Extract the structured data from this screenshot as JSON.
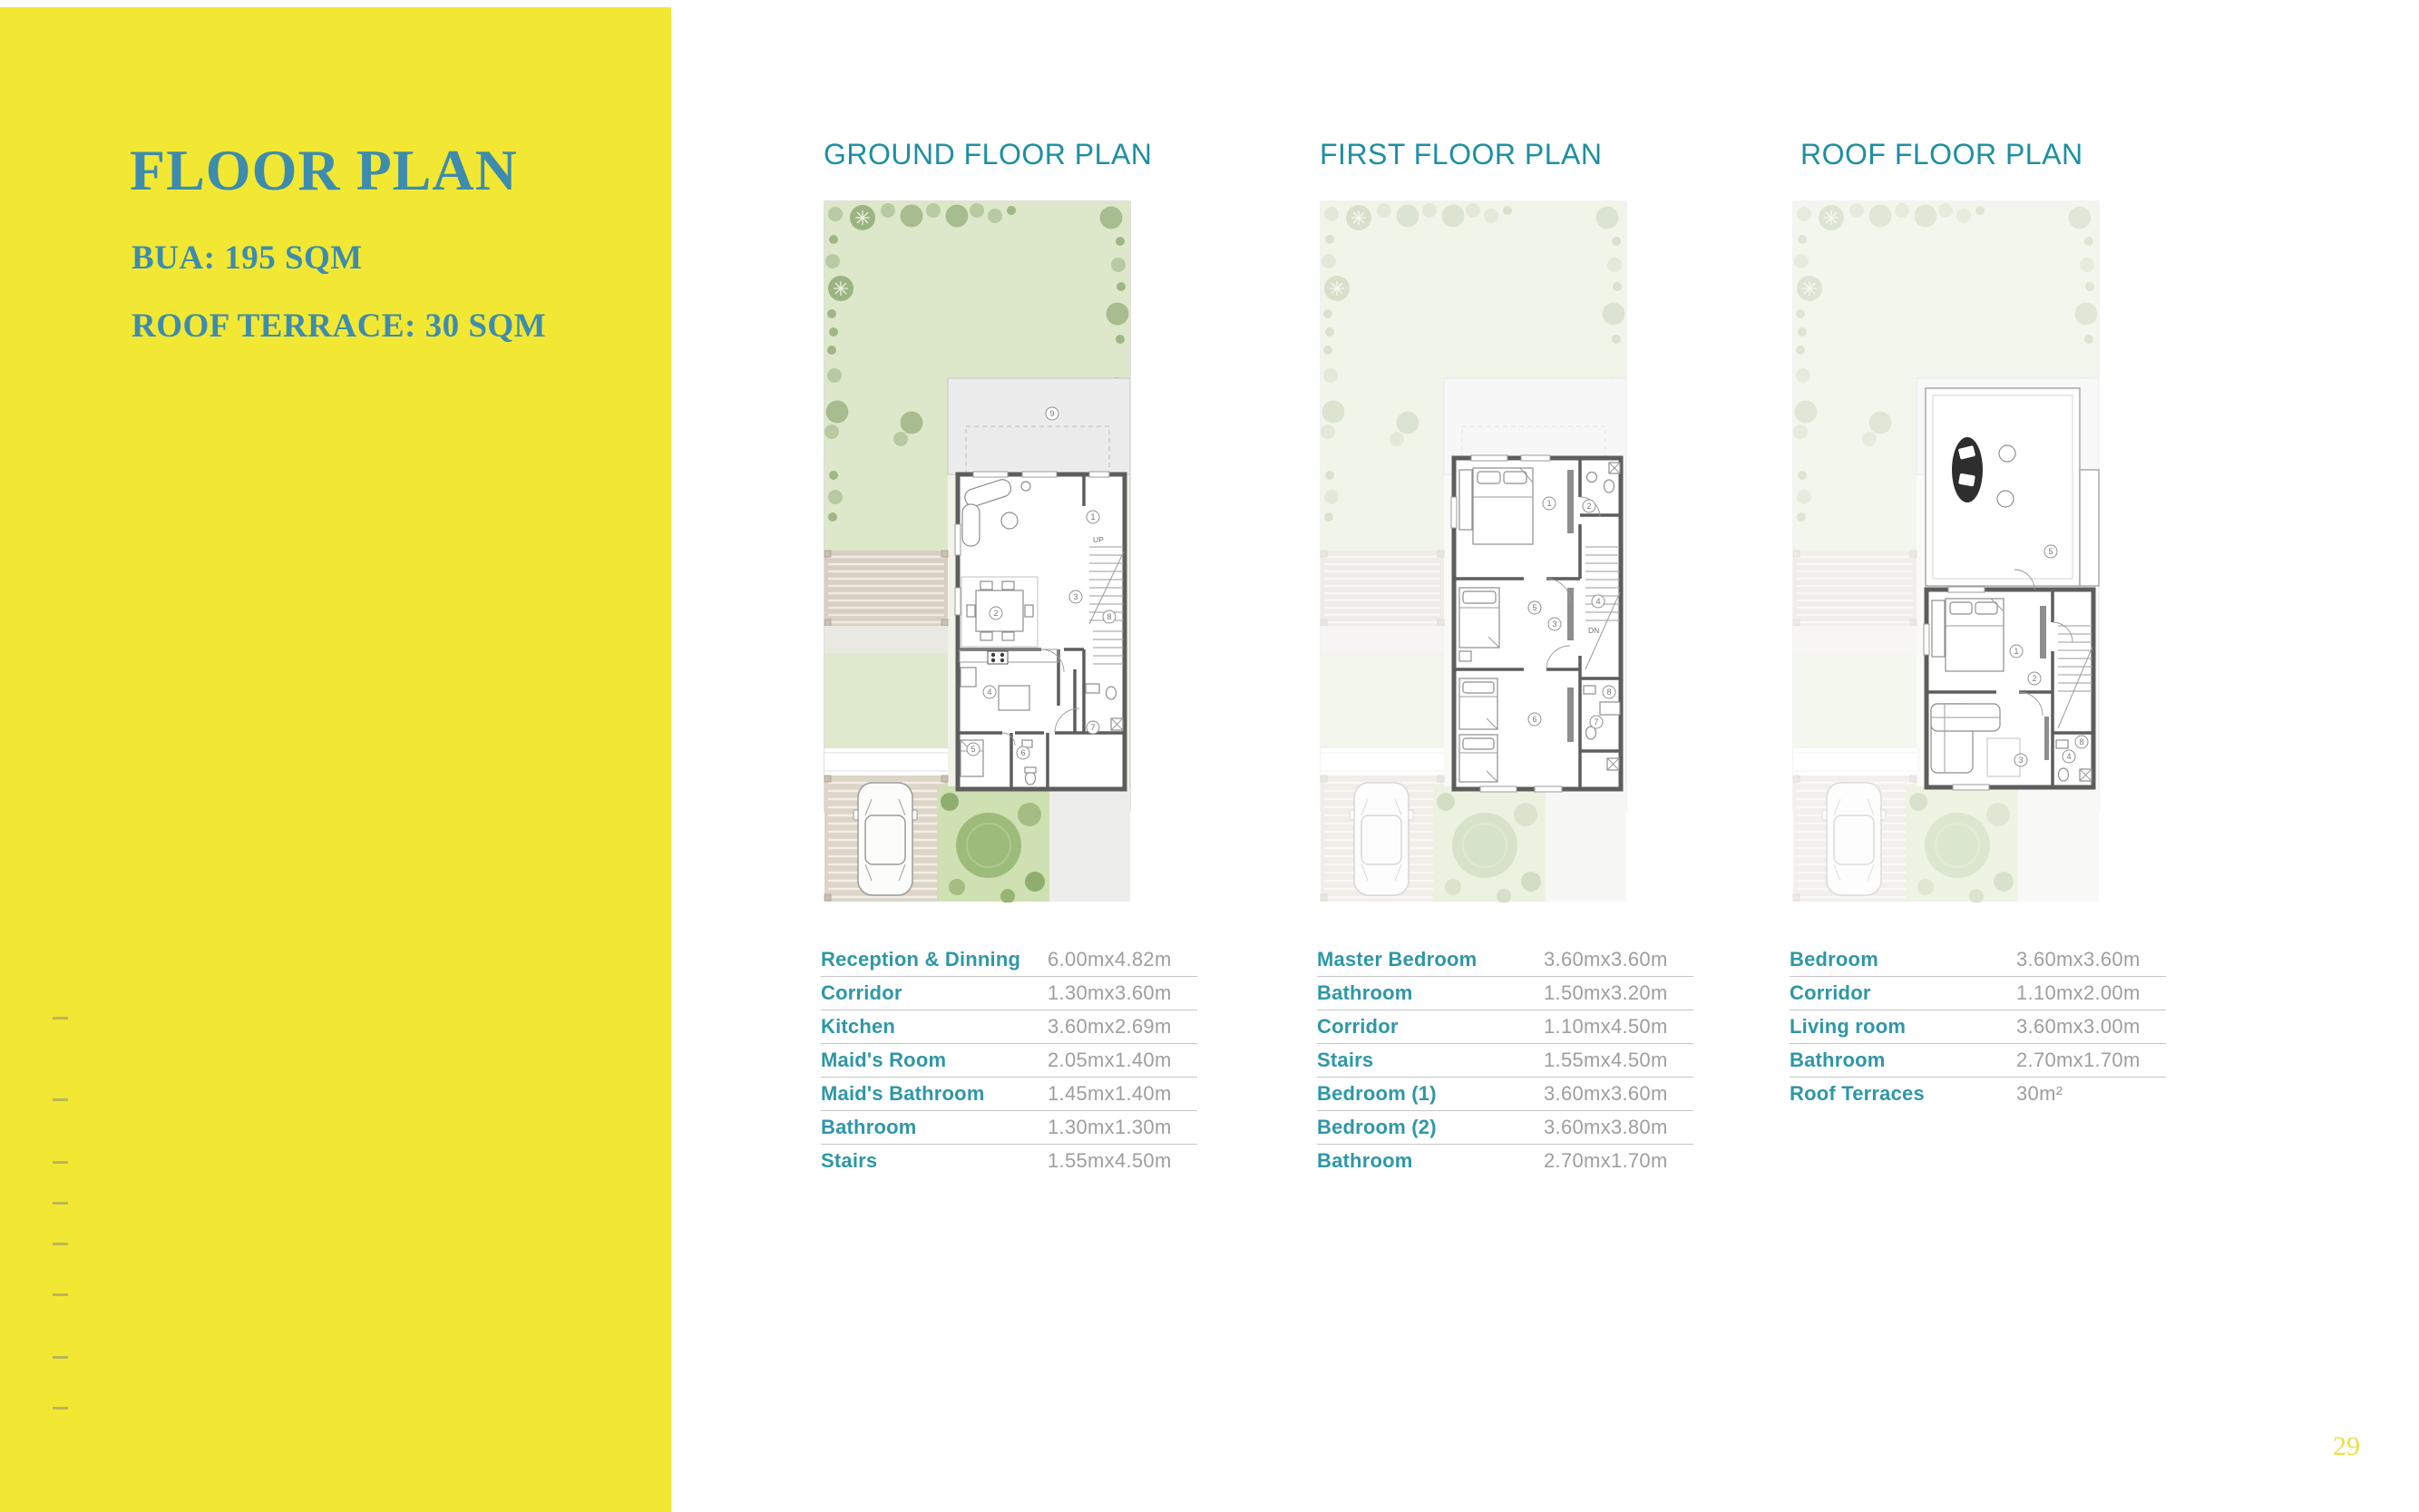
{
  "sidebar": {
    "title": "FLOOR PLAN",
    "bua": "BUA: 195 SQM",
    "roof_terrace": "ROOF TERRACE: 30 SQM",
    "background_color": "#F2E833",
    "text_color": "#3E8CAD"
  },
  "page_number": "29",
  "colors": {
    "heading_teal": "#1E8FA0",
    "table_label_teal": "#2F97A6",
    "dimension_gray": "#9E9E9E",
    "garden_green": "#DDE8CA",
    "page_number_yellow": "#E9DF45"
  },
  "plans": [
    {
      "title": "GROUND FLOOR PLAN",
      "image": "ground-floor-plan",
      "rooms": [
        {
          "label": "Reception & Dinning",
          "dim": "6.00mx4.82m"
        },
        {
          "label": "Corridor",
          "dim": "1.30mx3.60m"
        },
        {
          "label": "Kitchen",
          "dim": "3.60mx2.69m"
        },
        {
          "label": "Maid's Room",
          "dim": "2.05mx1.40m"
        },
        {
          "label": "Maid's Bathroom",
          "dim": "1.45mx1.40m"
        },
        {
          "label": "Bathroom",
          "dim": "1.30mx1.30m"
        },
        {
          "label": "Stairs",
          "dim": "1.55mx4.50m"
        }
      ],
      "stair_label": "UP"
    },
    {
      "title": "FIRST FLOOR PLAN",
      "image": "first-floor-plan",
      "rooms": [
        {
          "label": "Master Bedroom",
          "dim": "3.60mx3.60m"
        },
        {
          "label": "Bathroom",
          "dim": "1.50mx3.20m"
        },
        {
          "label": "Corridor",
          "dim": "1.10mx4.50m"
        },
        {
          "label": "Stairs",
          "dim": "1.55mx4.50m"
        },
        {
          "label": "Bedroom (1)",
          "dim": "3.60mx3.60m"
        },
        {
          "label": "Bedroom (2)",
          "dim": "3.60mx3.80m"
        },
        {
          "label": "Bathroom",
          "dim": "2.70mx1.70m"
        }
      ],
      "stair_label": "DN"
    },
    {
      "title": "ROOF FLOOR PLAN",
      "image": "roof-floor-plan",
      "rooms": [
        {
          "label": "Bedroom",
          "dim": "3.60mx3.60m"
        },
        {
          "label": "Corridor",
          "dim": "1.10mx2.00m"
        },
        {
          "label": "Living room",
          "dim": "3.60mx3.00m"
        },
        {
          "label": "Bathroom",
          "dim": "2.70mx1.70m"
        },
        {
          "label": "Roof Terraces",
          "dim": "30m²"
        }
      ],
      "stair_label": "DN"
    }
  ]
}
